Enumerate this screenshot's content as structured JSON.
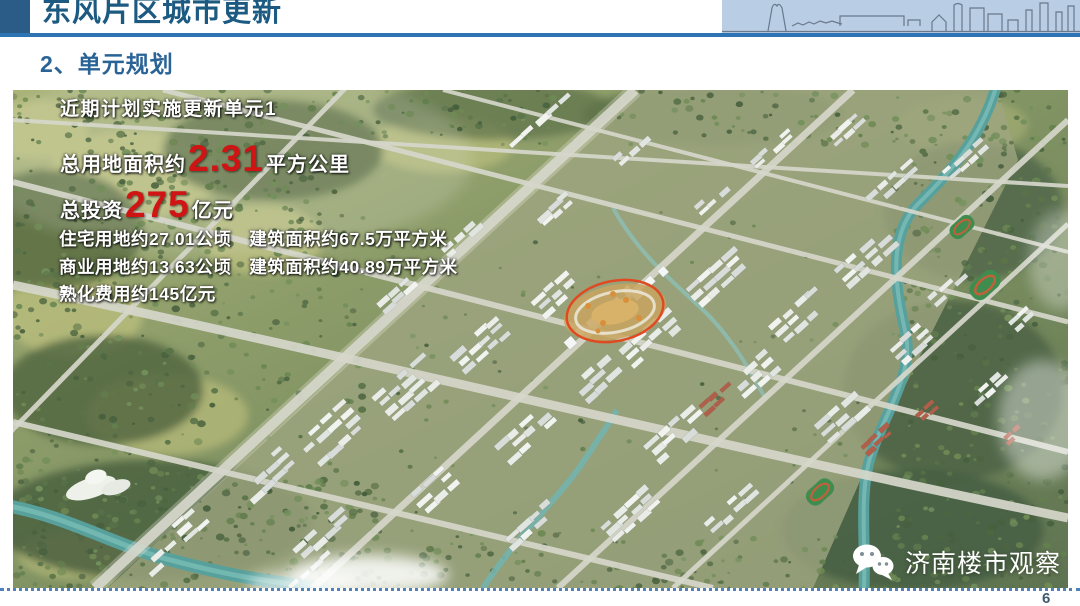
{
  "colors": {
    "accent": "#2e74b5",
    "title": "#1c5a82",
    "section": "#2a6496",
    "highlight": "#d01414",
    "footer_line": "#4f81bd",
    "page_number": "#3f5a6e",
    "annotation": "#e04a22",
    "skyline_bg": "#b9cde5"
  },
  "header": {
    "title": "东风片区城市更新"
  },
  "section": {
    "title": "2、单元规划"
  },
  "overlay": {
    "line1": "近期计划实施更新单元1",
    "area_label": "总用地面积约",
    "area_value": "2.31",
    "area_unit": "平方公里",
    "invest_label": "总投资",
    "invest_value": "275",
    "invest_unit": "亿元",
    "line_residential": "住宅用地约27.01公顷　建筑面积约67.5万平方米",
    "line_commercial": "商业用地约13.63公顷　建筑面积约40.89万平方米",
    "line_maturation": "熟化费用约145亿元"
  },
  "watermark": {
    "icon": "wechat-icon",
    "label": "济南楼市观察"
  },
  "footer": {
    "page_number": "6"
  }
}
